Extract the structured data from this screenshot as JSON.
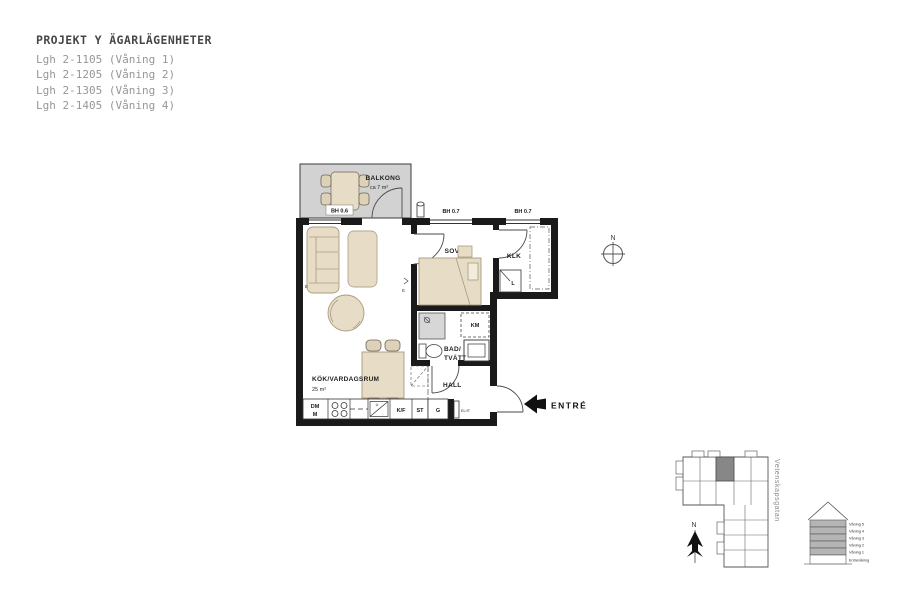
{
  "header": {
    "title": "PROJEKT Y ÄGARLÄGENHETER",
    "apartments": [
      "Lgh 2-1105 (Våning 1)",
      "Lgh 2-1205 (Våning 2)",
      "Lgh 2-1305 (Våning 3)",
      "Lgh 2-1405 (Våning 4)"
    ]
  },
  "floor_plan": {
    "balcony": {
      "label": "BALKONG",
      "area": "ca 7 m²",
      "parapet_height": "BH 0.6"
    },
    "windows": {
      "bedroom": "BH 0.7",
      "closet": "BH 0.7"
    },
    "bedroom": {
      "label": "SOV",
      "area": "8 m²"
    },
    "closet": {
      "label": "KLK",
      "linen_cabinet": "L"
    },
    "bathroom": {
      "label_line1": "BAD/",
      "label_line2": "TVÄTT",
      "combi_machine": "KM"
    },
    "hall": {
      "label": "HALL",
      "wardrobe": "G",
      "electrical_cabinet": "EL/IT"
    },
    "kitchen_living": {
      "label": "KÖK/VARDAGSRUM",
      "area": "25 m²",
      "dishwasher": "DM",
      "dishwasher_sub": "M",
      "sink_mark": "U",
      "fridge_freezer": "K/F",
      "pantry": "ST"
    },
    "entrance_label": "ENTRÉ",
    "electrical_mark": "E",
    "compass": "N"
  },
  "site_plan": {
    "street": "Vetenskapsgatan",
    "compass": "N"
  },
  "elevation": {
    "floors": [
      "Våning 5",
      "Våning 4",
      "Våning 3",
      "Våning 2",
      "Våning 1",
      "Entrévåning"
    ]
  },
  "colors": {
    "wall": "#1a1a1a",
    "furniture_fill": "#e7ddc6",
    "furniture_stroke": "#a89a7f",
    "balcony_fill": "#d2d2d2",
    "muted_text": "#979797",
    "site_highlight": "#878787"
  }
}
